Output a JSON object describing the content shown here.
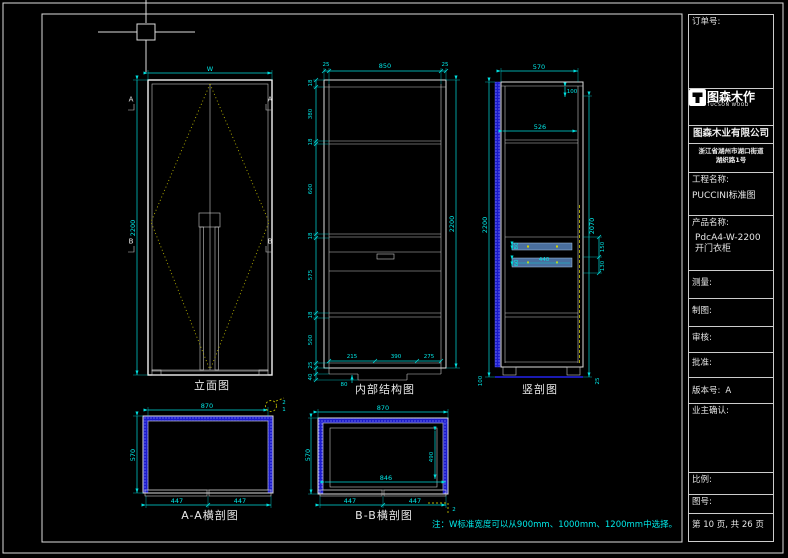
{
  "title_block": {
    "order_label": "订单号:",
    "logo": {
      "name": "图森木作",
      "sub": "TUCSON WOOD"
    },
    "company": "图森木业有限公司",
    "address_line1": "浙江省湖州市湖口街道",
    "address_line2": "湖织路1号",
    "project_label": "工程名称:",
    "project_value": "PUCCINI标准图",
    "product_label": "产品名称:",
    "product_line1": "PdcA4-W-2200",
    "product_line2": "开门衣柜",
    "measure_label": "测量:",
    "draft_label": "制图:",
    "audit_label": "审核:",
    "approve_label": "批准:",
    "version_label": "版本号:",
    "version_value": "A",
    "owner_label": "业主确认:",
    "scale_label": "比例:",
    "figure_no_label": "图号:",
    "page_label": "第 10 页, 共 26 页"
  },
  "views": {
    "elevation": {
      "label": "立面图",
      "width_dim": "W",
      "height_dim": "2200",
      "marker_a": "A",
      "marker_b": "B"
    },
    "internal": {
      "label": "内部结构图",
      "top_dims": [
        "25",
        "850",
        "25"
      ],
      "right_dim": "2200",
      "left_dims": [
        "18",
        "380",
        "18",
        "600",
        "18",
        "575",
        "18",
        "500",
        "25",
        "40"
      ],
      "bottom_dims": [
        "215",
        "390",
        "275"
      ],
      "plinth_dim": "80"
    },
    "vsection": {
      "label": "竖剖图",
      "top_dim": "570",
      "shelf_dim": "526",
      "top_small_dim": "100",
      "left_dim": "2200",
      "right_dim": "2070",
      "right_small_dims": [
        "150",
        "130"
      ],
      "drawer_width": "440",
      "drawer_h1": "80",
      "drawer_h2": "60",
      "bottom_left_dim": "100",
      "bottom_right_dim": "25"
    },
    "aa": {
      "label": "A-A横剖图",
      "top_dim": "870",
      "left_dim": "570",
      "bottom_dims": [
        "447",
        "447"
      ],
      "detail_nums": [
        "2",
        "1"
      ]
    },
    "bb": {
      "label": "B-B横剖图",
      "top_dim": "870",
      "left_dim": "570",
      "inner_width": "846",
      "inner_height": "490",
      "bottom_dims": [
        "447",
        "447"
      ],
      "detail_num": "2"
    }
  },
  "note": "注：W标准宽度可以从900mm、1000mm、1200mm中选择。",
  "colors": {
    "background": "#000000",
    "line": "#e8e8e8",
    "dimension": "#00e8e8",
    "swing_yellow": "#b8b400",
    "hatch_blue": "#1a1acc",
    "rail_blue": "#4a6f9e",
    "plinth_blue": "#2222ee"
  }
}
